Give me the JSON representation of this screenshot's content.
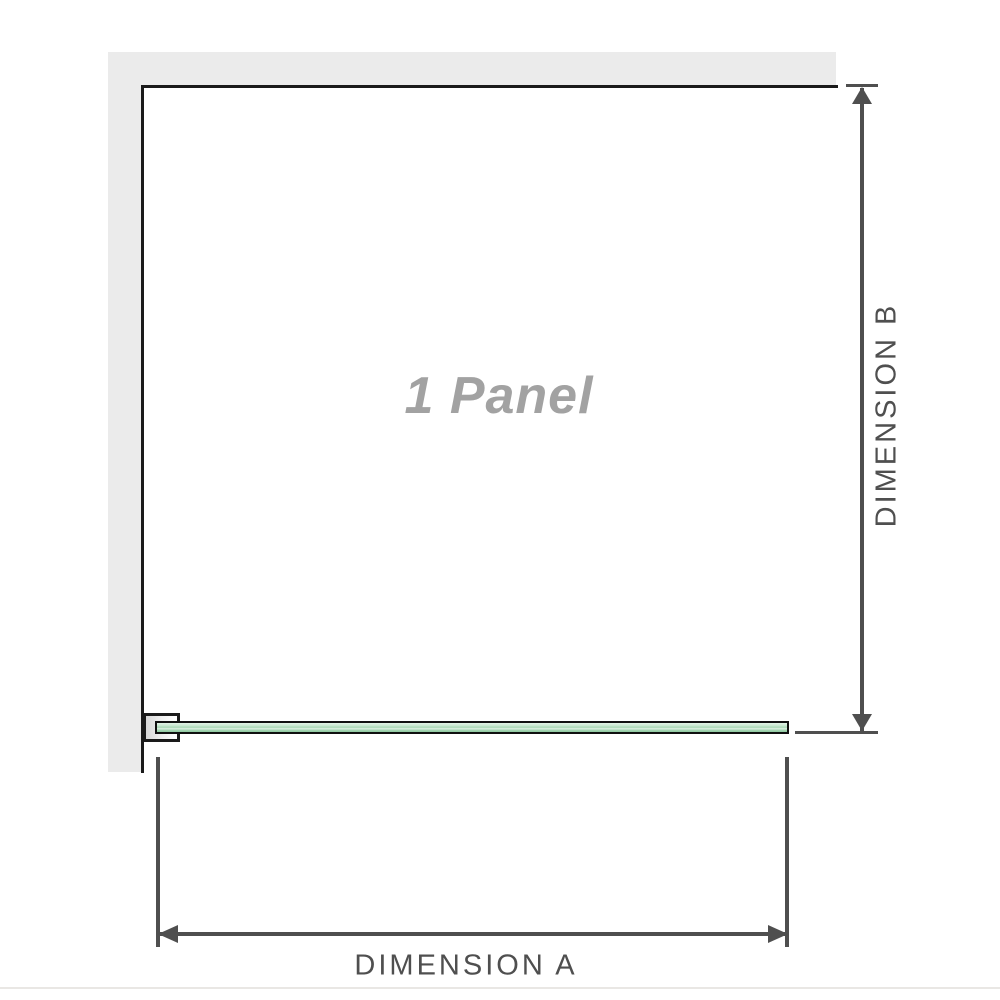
{
  "diagram": {
    "panel_label": "1 Panel",
    "dimensions": {
      "a": {
        "label": "DIMENSION A"
      },
      "b": {
        "label": "DIMENSION B"
      }
    },
    "colors": {
      "page_bg": "#ffffff",
      "wall": "#ebebeb",
      "outline": "#1a1a1a",
      "dimension": "#4f4f4f",
      "glass_border": "#101010",
      "glass_light": "#e3f2e7",
      "glass_mid": "#a8d7b5",
      "glass_deep": "#8fc8a0",
      "panel_label_color": "#a2a2a2",
      "footer_line": "#e9e7e4"
    }
  }
}
